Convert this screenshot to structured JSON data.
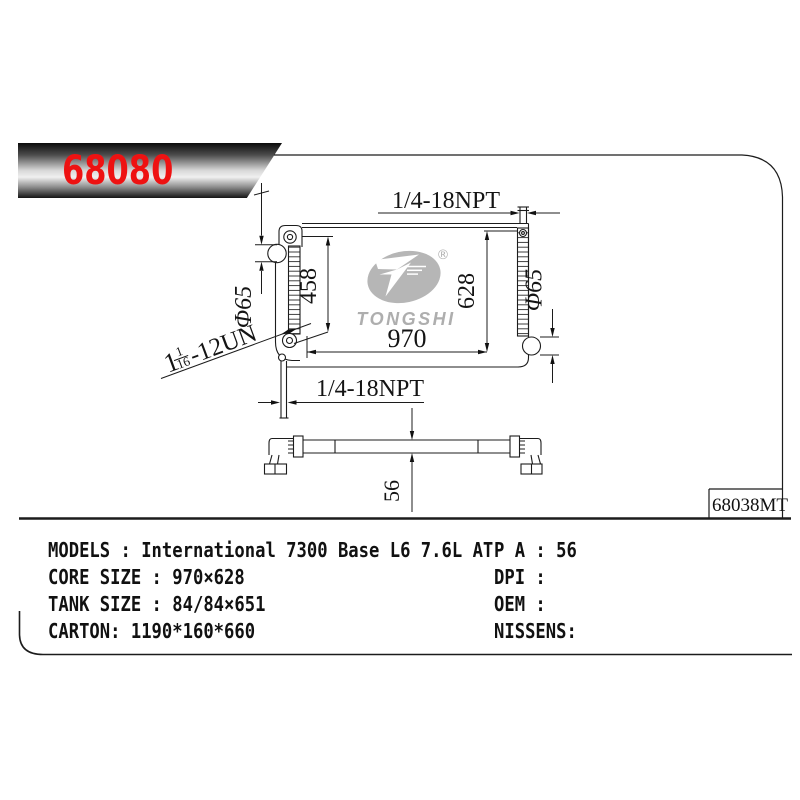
{
  "banner": {
    "part_number": "68080"
  },
  "title_block": {
    "ref_code": "68038MT"
  },
  "watermark": {
    "brand": "TONGSHI",
    "registered_mark": "®"
  },
  "dimensions": {
    "top_fitting": "1/4-18NPT",
    "bottom_fitting": "1/4-18NPT",
    "mount_span": "458",
    "core_height": "628",
    "core_width": "970",
    "filler_diameter": "Φ65",
    "outlet_diameter": "Φ65",
    "depth": "56",
    "thread_whole": "1",
    "thread_numerator": "1",
    "thread_denominator": "16",
    "thread_suffix": "-12UN"
  },
  "specs": {
    "left_rows": [
      "MODELS : International 7300 Base L6 7.6L AT",
      "CORE SIZE : 970×628",
      "TANK SIZE : 84/84×651",
      "CARTON: 1190*160*660"
    ],
    "right_rows": [
      "P A : 56",
      "DPI :",
      "OEM :",
      "NISSENS:"
    ]
  },
  "colors": {
    "part_number_red": "#ee1212",
    "line_ink": "#1c1c1c",
    "watermark_gray": "#b5b5b5"
  }
}
